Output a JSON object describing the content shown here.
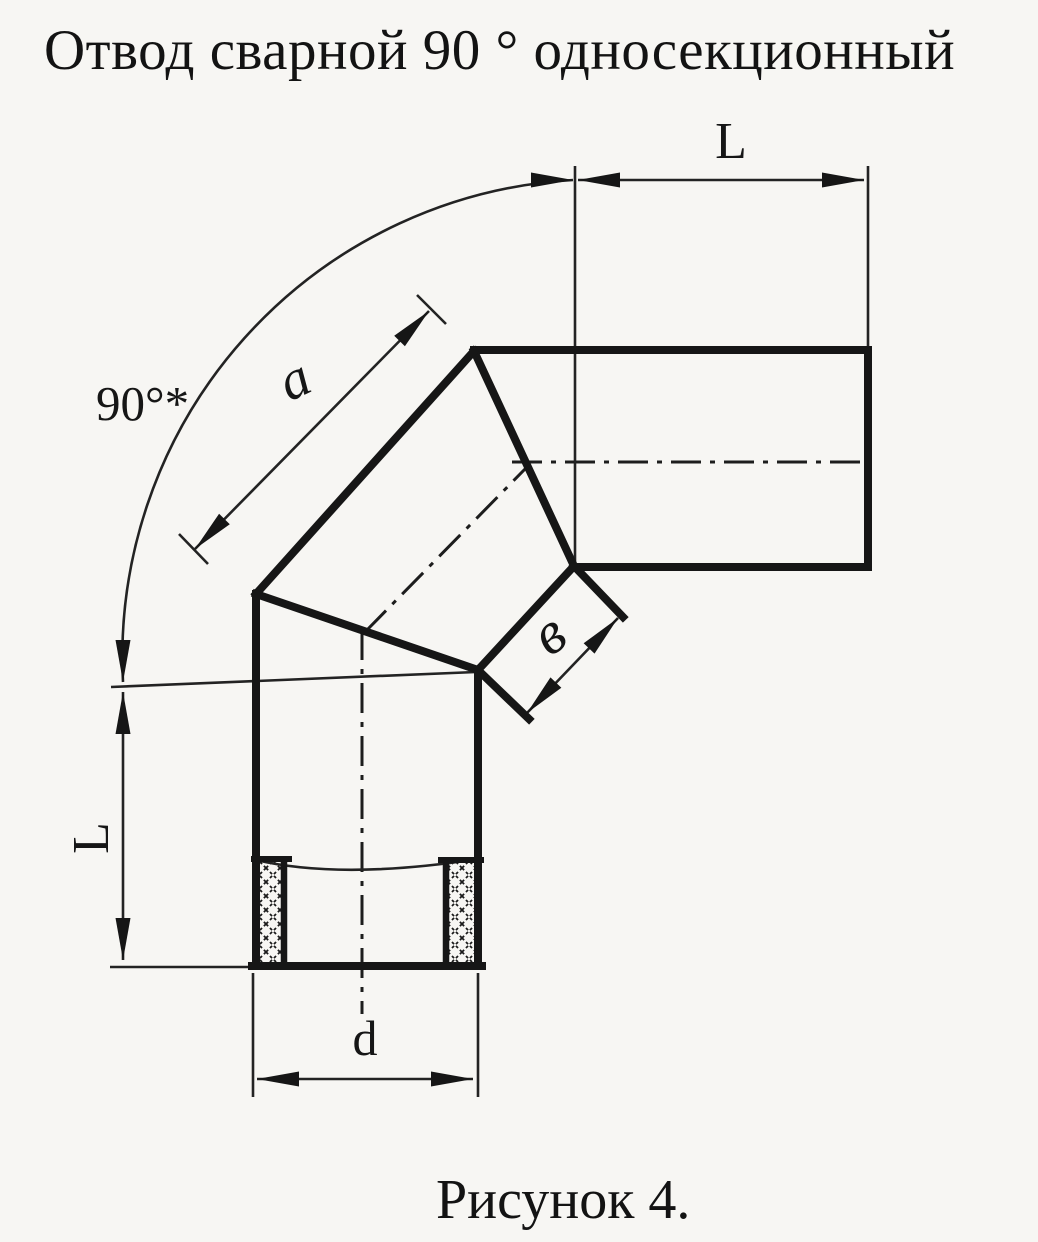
{
  "header": {
    "title": "Отвод сварной 90 ° односекционный"
  },
  "figure": {
    "caption": "Рисунок 4.",
    "kind": "welded 90° single-section pipe elbow, dimensioned technical drawing",
    "labels": {
      "angle": "90°*",
      "top_length": "L",
      "left_length": "L",
      "segment_outer": "a",
      "segment_inner": "в",
      "diameter": "d"
    }
  },
  "colors": {
    "ink": "#161616",
    "paper": "#f7f6f3"
  }
}
